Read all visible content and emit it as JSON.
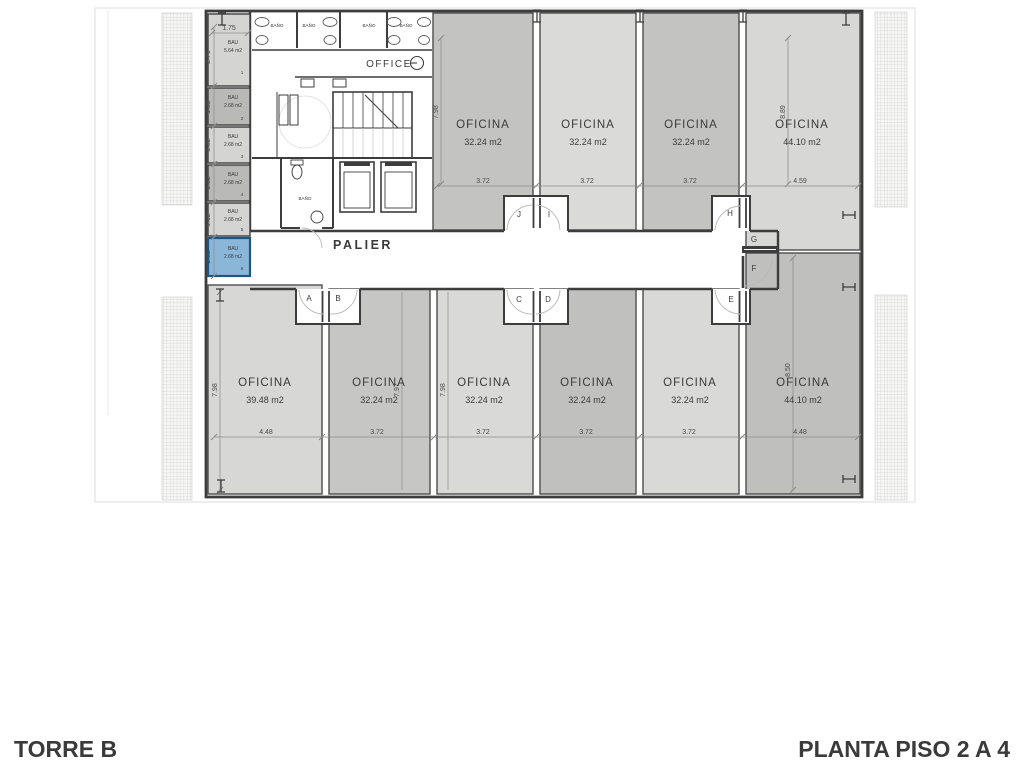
{
  "footer": {
    "left": "TORRE B",
    "right": "PLANTA PISO 2 A 4"
  },
  "labels": {
    "palier": "PALIER",
    "office": "OFFICE",
    "bano": "BAÑO"
  },
  "doors": {
    "a": "A",
    "b": "B",
    "c": "C",
    "d": "D",
    "e": "E",
    "f": "F",
    "g": "G",
    "h": "H",
    "i": "I",
    "j": "J"
  },
  "offices_top": [
    {
      "name": "OFICINA",
      "area": "32.24 m2",
      "width_dim": "3.72",
      "height_dim": "7.98"
    },
    {
      "name": "OFICINA",
      "area": "32.24 m2",
      "width_dim": "3.72"
    },
    {
      "name": "OFICINA",
      "area": "32.24 m2",
      "width_dim": "3.72"
    },
    {
      "name": "OFICINA",
      "area": "44.10 m2",
      "width_dim": "4.59",
      "height_dim": "8.89"
    }
  ],
  "offices_bottom": [
    {
      "name": "OFICINA",
      "area": "39.48 m2",
      "width_dim": "4.48",
      "height_dim": "7.98"
    },
    {
      "name": "OFICINA",
      "area": "32.24 m2",
      "width_dim": "3.72",
      "height_dim": "7.97"
    },
    {
      "name": "OFICINA",
      "area": "32.24 m2",
      "width_dim": "3.72",
      "height_dim": "7.98"
    },
    {
      "name": "OFICINA",
      "area": "32.24 m2",
      "width_dim": "3.72"
    },
    {
      "name": "OFICINA",
      "area": "32.24 m2",
      "width_dim": "3.72"
    },
    {
      "name": "OFICINA",
      "area": "44.10 m2",
      "width_dim": "4.48",
      "height_dim": "8.50"
    }
  ],
  "bau": {
    "title": "BAU",
    "width_dim": "1.75",
    "units": [
      {
        "area": "5.64 m2",
        "num": "1",
        "height_dim": "2.71"
      },
      {
        "area": "2.68 m2",
        "num": "2",
        "height_dim": "1.32"
      },
      {
        "area": "2.68 m2",
        "num": "3",
        "height_dim": "1.32"
      },
      {
        "area": "2.68 m2",
        "num": "4",
        "height_dim": "1.32"
      },
      {
        "area": "2.68 m2",
        "num": "5",
        "height_dim": "1.32"
      },
      {
        "area": "2.68 m2",
        "num": "6",
        "height_dim": "1.32",
        "highlighted": true
      }
    ]
  },
  "colors": {
    "wall": "#3d3d3d",
    "office_light": "#d9d9d7",
    "office_dark": "#c3c3c1",
    "bau_dark": "#b9b9b7",
    "highlight_fill": "#8ab6d8",
    "highlight_stroke": "#1f567e"
  }
}
